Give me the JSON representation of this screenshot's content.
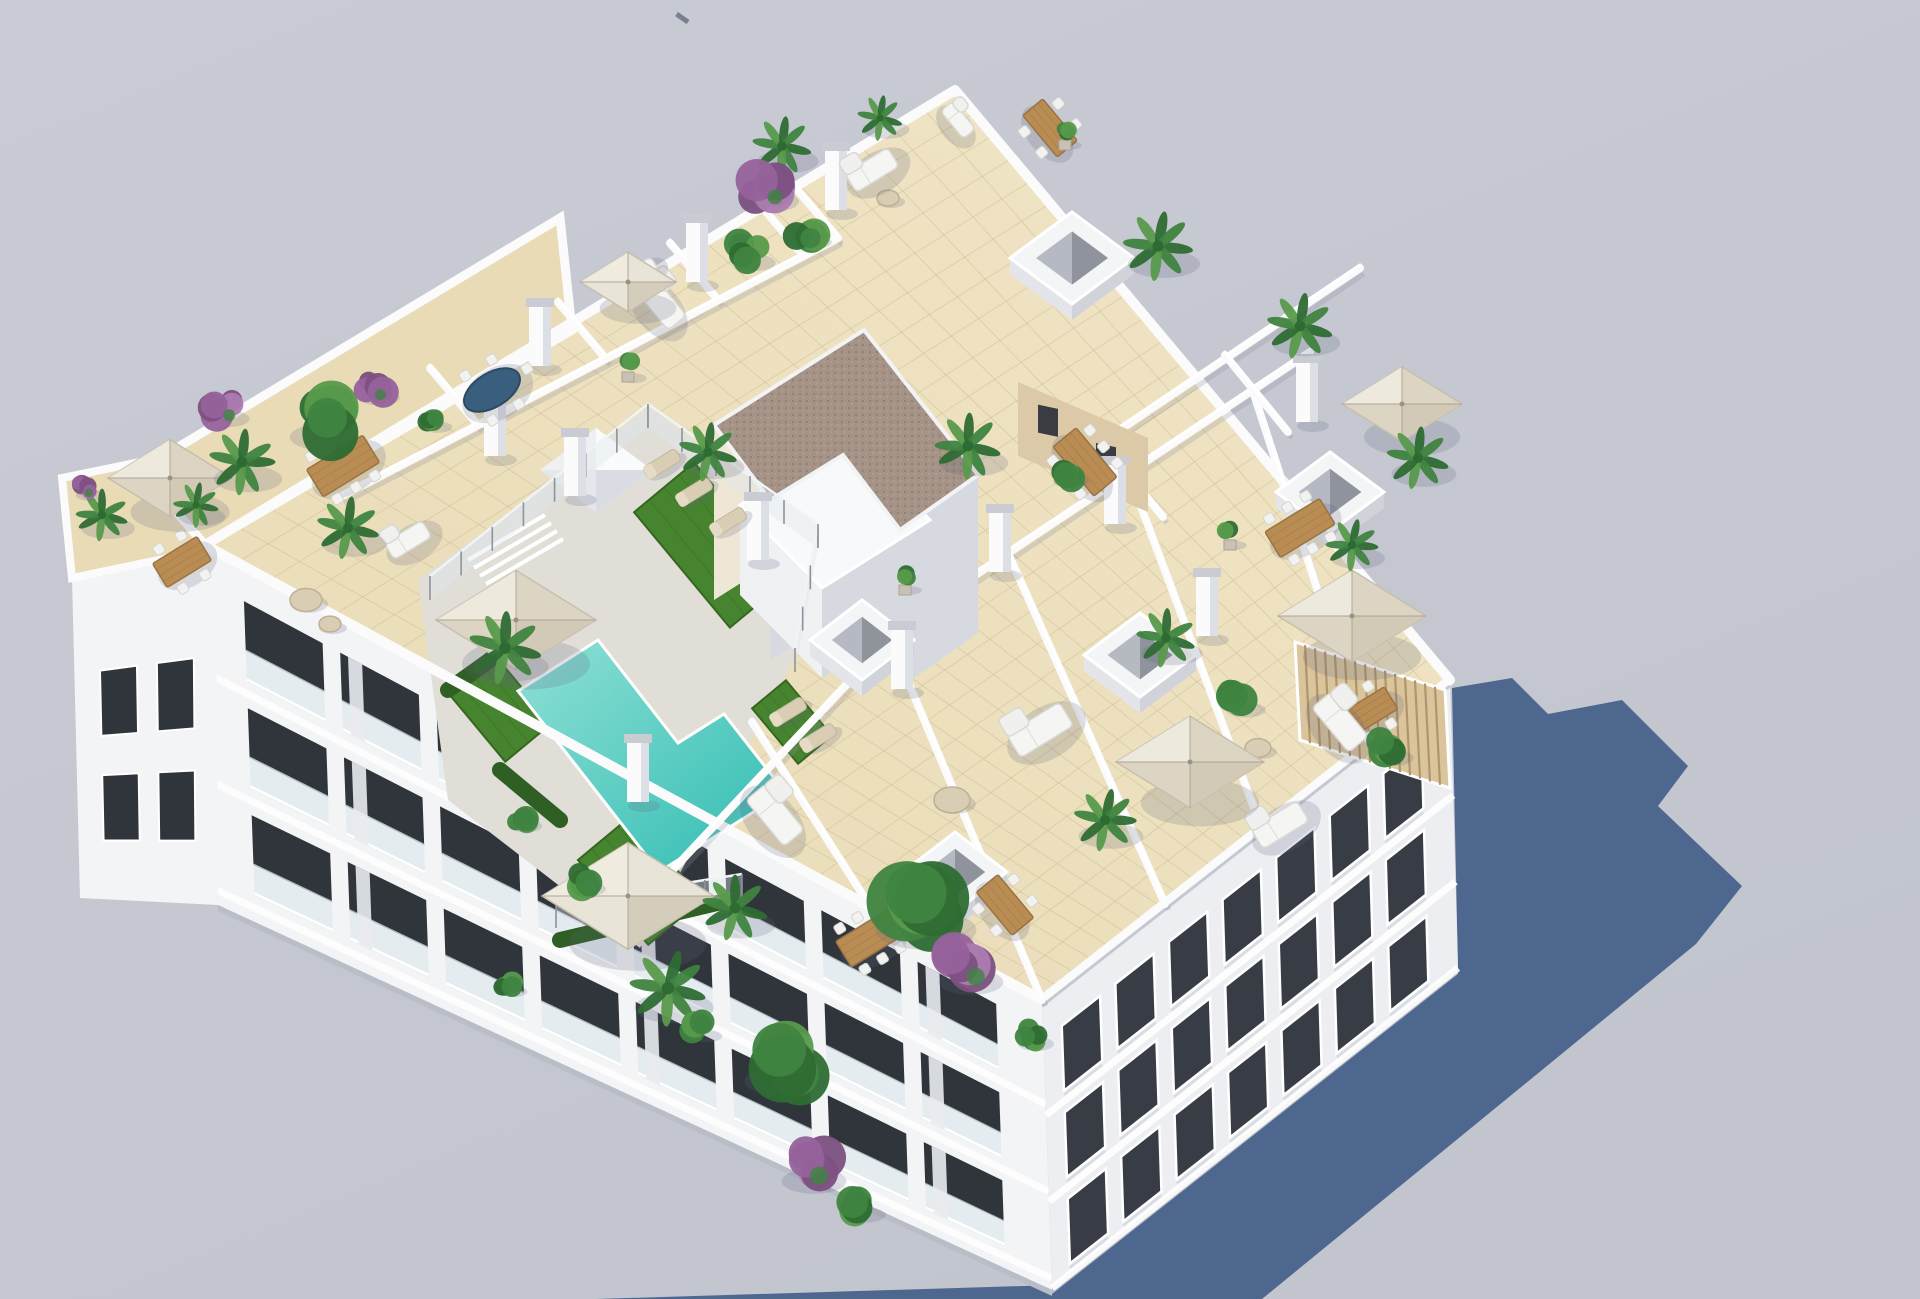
{
  "scene": {
    "description": "Aerial 3D architectural render of a white apartment block with a rooftop terrace: turquoise pool, artificial turf, parasols, dining sets, planted terraces and a long blue cast shadow",
    "width": 1920,
    "height": 1299
  },
  "palette": {
    "bg_top": "#c9cbd4",
    "bg_bottom": "#c2c5ce",
    "shadow": "#4e678f",
    "white_sun": "#f7f8f9",
    "white_wall": "#fbfbfc",
    "wall_shade": "#d6d9e0",
    "facade_left": "#f3f4f6",
    "facade_right": "#eceef2",
    "facade_base": "#b9bdc7",
    "tile": "#ead candy",
    "tile_light": "#f0e5c6",
    "tile_main": "#e9dbb6",
    "tile_line": "#cdbd93",
    "deck": "#e0ded7",
    "pool_light": "#8fe0d6",
    "pool_deep": "#2fbcb1",
    "turf": "#47842f",
    "turf_dark": "#35671f",
    "hedge": "#2f5f24",
    "gravel": "#a49386",
    "gravel_dot": "#8d7b6e",
    "cream_wall": "#efe7d6",
    "tan_wall": "#dcc9a8",
    "pergola": "#d9c49c",
    "pergola_line": "#b1946a",
    "wood": "#b98c54",
    "wood_dark": "#9a7342",
    "chair": "#f2f2f0",
    "blue_table": "#3a5f7e",
    "umbrella_beige": "#ddd5c3",
    "umbrella_light": "#e9e4d8",
    "umbrella_seam": "#a69f8e",
    "window_dark": "#30353c",
    "window_right": "#383d45",
    "glass": "#dfe9ee",
    "fence_post": "#8d939c",
    "plant_dark": "#2e6b33",
    "plant_mid": "#3f8440",
    "plant_light": "#579a4b",
    "purple_dark": "#7b5080",
    "purple_mid": "#96629b",
    "purple_light": "#ab7cb0",
    "lounger": "#d9cdb4",
    "ao": "rgba(95,98,125,0.20)",
    "speck": "#6a7383"
  },
  "geometry": {
    "roof": [
      [
        205,
        545
      ],
      [
        955,
        90
      ],
      [
        1450,
        680
      ],
      [
        1042,
        1000
      ]
    ],
    "facade_left": [
      [
        205,
        545
      ],
      [
        1042,
        1000
      ],
      [
        1052,
        1290
      ],
      [
        218,
        905
      ]
    ],
    "facade_right": [
      [
        1042,
        1000
      ],
      [
        1450,
        680
      ],
      [
        1458,
        968
      ],
      [
        1052,
        1288
      ]
    ],
    "annex_roof": [
      [
        62,
        478
      ],
      [
        208,
        448
      ],
      [
        216,
        548
      ],
      [
        72,
        578
      ]
    ],
    "annex_facade": [
      [
        72,
        578
      ],
      [
        216,
        548
      ],
      [
        218,
        905
      ],
      [
        80,
        898
      ]
    ],
    "band_nw": [
      [
        140,
        470
      ],
      [
        560,
        218
      ],
      [
        572,
        330
      ],
      [
        205,
        545
      ]
    ],
    "shadow_poly": [
      [
        596,
        1299
      ],
      [
        1056,
        1285
      ],
      [
        1458,
        968
      ],
      [
        1452,
        688
      ],
      [
        1512,
        678
      ],
      [
        1548,
        714
      ],
      [
        1622,
        700
      ],
      [
        1688,
        766
      ],
      [
        1658,
        806
      ],
      [
        1742,
        886
      ],
      [
        1696,
        944
      ],
      [
        1262,
        1299
      ]
    ],
    "speck": {
      "x": 678,
      "y": 12,
      "w": 14,
      "h": 5,
      "rot": 35
    },
    "deck": [
      [
        418,
        580
      ],
      [
        650,
        408
      ],
      [
        832,
        548
      ],
      [
        800,
        648
      ],
      [
        640,
        948
      ],
      [
        448,
        800
      ]
    ],
    "pool": [
      [
        598,
        640
      ],
      [
        678,
        743
      ],
      [
        724,
        714
      ],
      [
        785,
        792
      ],
      [
        659,
        872
      ],
      [
        518,
        691
      ]
    ],
    "gravel_roof": [
      [
        864,
        330
      ],
      [
        978,
        475
      ],
      [
        900,
        530
      ],
      [
        843,
        455
      ],
      [
        770,
        500
      ],
      [
        714,
        425
      ]
    ],
    "struct_sw_wall": [
      [
        714,
        425
      ],
      [
        864,
        330
      ],
      [
        864,
        505
      ],
      [
        714,
        600
      ]
    ],
    "struct_se_wall1": [
      [
        978,
        475
      ],
      [
        900,
        530
      ],
      [
        900,
        688
      ],
      [
        978,
        633
      ]
    ],
    "struct_se_wall2": [
      [
        843,
        455
      ],
      [
        770,
        500
      ],
      [
        770,
        660
      ],
      [
        843,
        615
      ]
    ],
    "struct_annex_top": [
      [
        740,
        505
      ],
      [
        848,
        438
      ],
      [
        930,
        520
      ],
      [
        822,
        588
      ]
    ],
    "struct_annex_front": [
      [
        740,
        505
      ],
      [
        822,
        588
      ],
      [
        822,
        678
      ],
      [
        740,
        595
      ]
    ],
    "struct_annex_right": [
      [
        822,
        588
      ],
      [
        930,
        520
      ],
      [
        930,
        610
      ],
      [
        822,
        678
      ]
    ],
    "tan_annex": [
      [
        1018,
        382
      ],
      [
        1148,
        438
      ],
      [
        1148,
        512
      ],
      [
        1018,
        456
      ]
    ],
    "tan_windows": [
      [
        1038,
        404,
        20,
        28
      ],
      [
        1096,
        430,
        20,
        28
      ]
    ],
    "pergola": [
      [
        1295,
        642
      ],
      [
        1445,
        690
      ],
      [
        1450,
        788
      ],
      [
        1300,
        740
      ]
    ],
    "turf_patches": [
      {
        "x": 712,
        "y": 545,
        "l": 150,
        "w": 78
      },
      {
        "x": 498,
        "y": 706,
        "l": 95,
        "w": 60
      },
      {
        "x": 640,
        "y": 880,
        "l": 110,
        "w": 70
      },
      {
        "x": 792,
        "y": 722,
        "l": 72,
        "w": 44
      }
    ],
    "hedges": [
      [
        448,
        690,
        560,
        610
      ],
      [
        560,
        940,
        730,
        900
      ],
      [
        500,
        770,
        560,
        820
      ]
    ],
    "fence": [
      [
        430,
        600,
        648,
        428
      ],
      [
        648,
        428,
        818,
        548
      ],
      [
        818,
        548,
        795,
        672
      ],
      [
        556,
        928,
        742,
        898
      ]
    ],
    "steps": [
      [
        468,
        560,
        545,
        515
      ],
      [
        474,
        568,
        551,
        523
      ],
      [
        480,
        576,
        557,
        531
      ],
      [
        486,
        584,
        563,
        539
      ]
    ],
    "walls": [
      [
        430,
        368,
        478,
        425
      ],
      [
        558,
        302,
        606,
        359
      ],
      [
        670,
        243,
        718,
        300
      ],
      [
        790,
        181,
        838,
        238
      ],
      [
        758,
        202,
        798,
        250
      ],
      [
        340,
        497,
        838,
        238
      ],
      [
        640,
        905,
        905,
        622
      ],
      [
        905,
        622,
        1008,
        553
      ],
      [
        1008,
        553,
        1310,
        352
      ],
      [
        752,
        722,
        868,
        903
      ],
      [
        888,
        634,
        1042,
        1000
      ],
      [
        1008,
        553,
        1165,
        904
      ],
      [
        1128,
        472,
        1262,
        829
      ],
      [
        1252,
        388,
        1368,
        745
      ],
      [
        1060,
        470,
        1360,
        268
      ],
      [
        1100,
        440,
        1163,
        517
      ],
      [
        1225,
        355,
        1288,
        432
      ]
    ],
    "pillars": [
      [
        697,
        278
      ],
      [
        540,
        362
      ],
      [
        836,
        206
      ],
      [
        495,
        452
      ],
      [
        575,
        492
      ],
      [
        1000,
        568
      ],
      [
        902,
        685
      ],
      [
        638,
        798
      ],
      [
        1207,
        632
      ],
      [
        1307,
        418
      ],
      [
        758,
        556
      ],
      [
        1115,
        520
      ]
    ],
    "skylights": [
      {
        "x": 1072,
        "y": 258,
        "rx": 62,
        "ry": 46,
        "kind": "open"
      },
      {
        "x": 596,
        "y": 470,
        "rx": 56,
        "ry": 42,
        "kind": "pyramid"
      },
      {
        "x": 862,
        "y": 640,
        "rx": 52,
        "ry": 40,
        "kind": "open"
      },
      {
        "x": 955,
        "y": 872,
        "rx": 52,
        "ry": 40,
        "kind": "open"
      },
      {
        "x": 1140,
        "y": 655,
        "rx": 56,
        "ry": 42,
        "kind": "open"
      },
      {
        "x": 1330,
        "y": 492,
        "rx": 54,
        "ry": 40,
        "kind": "open"
      }
    ],
    "left_rows": [
      0.1,
      0.4,
      0.7
    ],
    "left_cols": 8,
    "right_rows": [
      0.14,
      0.44,
      0.74
    ],
    "right_cols": 7
  },
  "furniture": {
    "umbrellas": [
      {
        "x": 170,
        "y": 478,
        "s": 62,
        "tone": "beige"
      },
      {
        "x": 516,
        "y": 620,
        "s": 80,
        "tone": "beige"
      },
      {
        "x": 628,
        "y": 896,
        "s": 86,
        "tone": "light"
      },
      {
        "x": 628,
        "y": 282,
        "s": 48,
        "tone": "light"
      },
      {
        "x": 1190,
        "y": 762,
        "s": 74,
        "tone": "beige"
      },
      {
        "x": 1352,
        "y": 616,
        "s": 74,
        "tone": "beige"
      },
      {
        "x": 1402,
        "y": 404,
        "s": 60,
        "tone": "beige"
      }
    ],
    "tables": [
      {
        "x": 182,
        "y": 562,
        "l": 52,
        "w": 28,
        "dir": "u",
        "chairs": 4,
        "top": "wood"
      },
      {
        "x": 343,
        "y": 466,
        "l": 66,
        "w": 32,
        "dir": "u",
        "chairs": 6,
        "top": "wood"
      },
      {
        "x": 492,
        "y": 390,
        "l": 62,
        "w": 34,
        "dir": "u",
        "chairs": 5,
        "top": "blue",
        "oval": true
      },
      {
        "x": 1050,
        "y": 128,
        "l": 54,
        "w": 26,
        "dir": "v",
        "chairs": 4,
        "top": "wood"
      },
      {
        "x": 1085,
        "y": 462,
        "l": 64,
        "w": 30,
        "dir": "v",
        "chairs": 6,
        "top": "wood"
      },
      {
        "x": 1300,
        "y": 528,
        "l": 64,
        "w": 30,
        "dir": "u",
        "chairs": 6,
        "top": "wood"
      },
      {
        "x": 870,
        "y": 938,
        "l": 62,
        "w": 30,
        "dir": "u",
        "chairs": 6,
        "top": "wood"
      },
      {
        "x": 1005,
        "y": 905,
        "l": 56,
        "w": 28,
        "dir": "v",
        "chairs": 4,
        "top": "wood"
      },
      {
        "x": 1368,
        "y": 712,
        "l": 54,
        "w": 26,
        "dir": "u",
        "chairs": 4,
        "top": "wood"
      }
    ],
    "round_tables": [
      [
        306,
        600,
        16
      ],
      [
        330,
        624,
        11
      ],
      [
        952,
        800,
        18
      ],
      [
        888,
        198,
        11
      ],
      [
        1258,
        748,
        13
      ]
    ],
    "sofas": [
      {
        "x": 872,
        "y": 170,
        "dir": "u",
        "s": 50
      },
      {
        "x": 660,
        "y": 302,
        "dir": "v",
        "s": 54
      },
      {
        "x": 1040,
        "y": 730,
        "dir": "u",
        "s": 62
      },
      {
        "x": 1340,
        "y": 722,
        "dir": "v",
        "s": 58
      },
      {
        "x": 1280,
        "y": 825,
        "dir": "u",
        "s": 54
      },
      {
        "x": 775,
        "y": 815,
        "dir": "v",
        "s": 60
      },
      {
        "x": 408,
        "y": 540,
        "dir": "u",
        "s": 44
      },
      {
        "x": 640,
        "y": 272,
        "dir": "u",
        "s": 34
      },
      {
        "x": 958,
        "y": 120,
        "dir": "v",
        "s": 36
      }
    ],
    "loungers": [
      [
        694,
        492
      ],
      [
        728,
        522
      ],
      [
        662,
        464
      ],
      [
        788,
        712
      ],
      [
        818,
        738
      ]
    ]
  },
  "plants": [
    {
      "t": "palm",
      "x": 242,
      "y": 462,
      "r": 38
    },
    {
      "t": "palm",
      "x": 348,
      "y": 528,
      "r": 36
    },
    {
      "t": "palm",
      "x": 505,
      "y": 648,
      "r": 42
    },
    {
      "t": "palm",
      "x": 708,
      "y": 452,
      "r": 34
    },
    {
      "t": "palm",
      "x": 668,
      "y": 988,
      "r": 44
    },
    {
      "t": "palm",
      "x": 782,
      "y": 146,
      "r": 34
    },
    {
      "t": "palm",
      "x": 880,
      "y": 118,
      "r": 26
    },
    {
      "t": "palm",
      "x": 1158,
      "y": 246,
      "r": 40
    },
    {
      "t": "palm",
      "x": 1300,
      "y": 326,
      "r": 38
    },
    {
      "t": "palm",
      "x": 1418,
      "y": 458,
      "r": 36
    },
    {
      "t": "palm",
      "x": 968,
      "y": 446,
      "r": 38
    },
    {
      "t": "palm",
      "x": 1166,
      "y": 638,
      "r": 34
    },
    {
      "t": "palm",
      "x": 735,
      "y": 908,
      "r": 38
    },
    {
      "t": "palm",
      "x": 1105,
      "y": 820,
      "r": 36
    },
    {
      "t": "palm",
      "x": 102,
      "y": 515,
      "r": 30
    },
    {
      "t": "palm",
      "x": 196,
      "y": 505,
      "r": 26
    },
    {
      "t": "palm",
      "x": 1352,
      "y": 545,
      "r": 30
    },
    {
      "t": "tree",
      "x": 318,
      "y": 420,
      "r": 38
    },
    {
      "t": "tree",
      "x": 920,
      "y": 905,
      "r": 56
    },
    {
      "t": "tree",
      "x": 780,
      "y": 1060,
      "r": 46
    },
    {
      "t": "bush",
      "x": 432,
      "y": 420,
      "r": 16
    },
    {
      "t": "bush",
      "x": 806,
      "y": 232,
      "r": 22
    },
    {
      "t": "bush",
      "x": 748,
      "y": 252,
      "r": 24
    },
    {
      "t": "bush",
      "x": 1030,
      "y": 1035,
      "r": 20
    },
    {
      "t": "bush",
      "x": 1240,
      "y": 700,
      "r": 22
    },
    {
      "t": "bush",
      "x": 1065,
      "y": 472,
      "r": 20
    },
    {
      "t": "bush",
      "x": 582,
      "y": 880,
      "r": 20
    },
    {
      "t": "bush",
      "x": 520,
      "y": 818,
      "r": 18
    },
    {
      "t": "bush",
      "x": 860,
      "y": 1205,
      "r": 22
    },
    {
      "t": "bush",
      "x": 700,
      "y": 1028,
      "r": 18
    },
    {
      "t": "bush",
      "x": 1388,
      "y": 748,
      "r": 22
    },
    {
      "t": "bush",
      "x": 508,
      "y": 985,
      "r": 15
    },
    {
      "t": "purple",
      "x": 766,
      "y": 188,
      "r": 30
    },
    {
      "t": "purple",
      "x": 222,
      "y": 408,
      "r": 24
    },
    {
      "t": "purple",
      "x": 374,
      "y": 388,
      "r": 22
    },
    {
      "t": "purple",
      "x": 965,
      "y": 966,
      "r": 36
    },
    {
      "t": "purple",
      "x": 84,
      "y": 488,
      "r": 16
    },
    {
      "t": "purple",
      "x": 808,
      "y": 1165,
      "r": 36
    },
    {
      "t": "pot",
      "x": 628,
      "y": 372,
      "r": 14
    },
    {
      "t": "pot",
      "x": 1065,
      "y": 140,
      "r": 12
    },
    {
      "t": "pot",
      "x": 1230,
      "y": 540,
      "r": 12
    },
    {
      "t": "pot",
      "x": 905,
      "y": 585,
      "r": 12
    }
  ]
}
